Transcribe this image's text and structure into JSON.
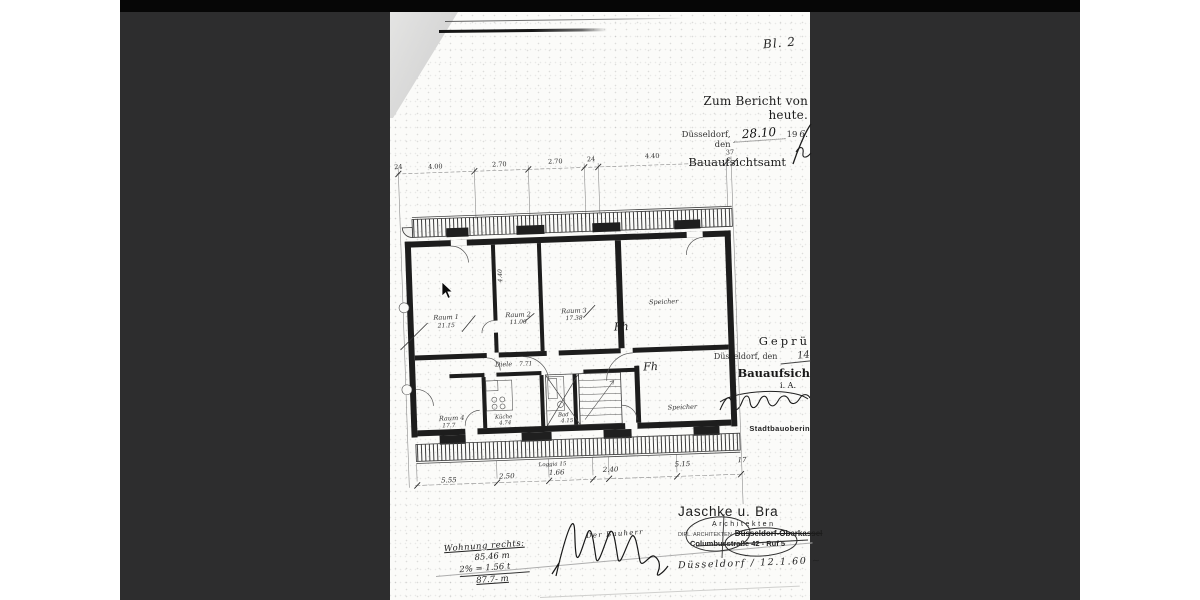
{
  "scan": {
    "bg": "#2d2d2e",
    "top_strip": "#060606",
    "paper": "#fbfbf9",
    "fold": "#d8d8d8",
    "ink": "#2a2a2a"
  },
  "page_label": "Bl. 2",
  "report_note": {
    "line1": "Zum Bericht von heute.",
    "city_prefix": "Düsseldorf, den",
    "date_hand": "28.10",
    "year": "19",
    "year_hand": "6.",
    "office": "Bauaufsichtsamt"
  },
  "approval_stamp": {
    "title": "Geprü",
    "city_prefix": "Düsseldorf, den",
    "date_hand": "14",
    "office": "Bauaufsich",
    "initials": "i. A.",
    "role": "Stadtbauoberin"
  },
  "architect_stamp": {
    "name": "Jaschke u. Bra",
    "profession": "Architekten",
    "qualifier": "DIPL. ARCHITEKTEN",
    "location_struck": "Düsseldorf-Oberkassel",
    "address": "Columbusstraße 42 - Ruf 5",
    "handwritten": "Düsseldorf / 12.1.60 ~"
  },
  "area_calc": {
    "title": "Wohnung rechts:",
    "line1": "85.46 m",
    "line2": "2% = 1.56 t",
    "total": "87.7- m",
    "signer": "Der Bauherr"
  },
  "floor_plan": {
    "rooms": [
      {
        "name": "Raum 1",
        "area": "21.15"
      },
      {
        "name": "Raum 2",
        "area": "11.06"
      },
      {
        "name": "Raum 3",
        "area": "17.38"
      },
      {
        "name": "Speicher",
        "area": ""
      },
      {
        "name": "Diele",
        "area": "7.71"
      },
      {
        "name": "Küche",
        "area": "4.74"
      },
      {
        "name": "Bad",
        "area": "4.15"
      },
      {
        "name": "Raum 4",
        "area": "17.7"
      },
      {
        "name": "Speicher",
        "area": ""
      }
    ],
    "dims_top": [
      "24",
      "4.00",
      "2.70",
      "2.70",
      "24",
      "4.40",
      "37"
    ],
    "dims_bottom": [
      "5.55",
      "2.50",
      "1.66",
      "2.40",
      "5.15",
      "17"
    ],
    "loggia": "Loggia 15",
    "annotations": {
      "fh1": "Fh",
      "fh2": "Fh",
      "vdim": "4.40"
    }
  }
}
